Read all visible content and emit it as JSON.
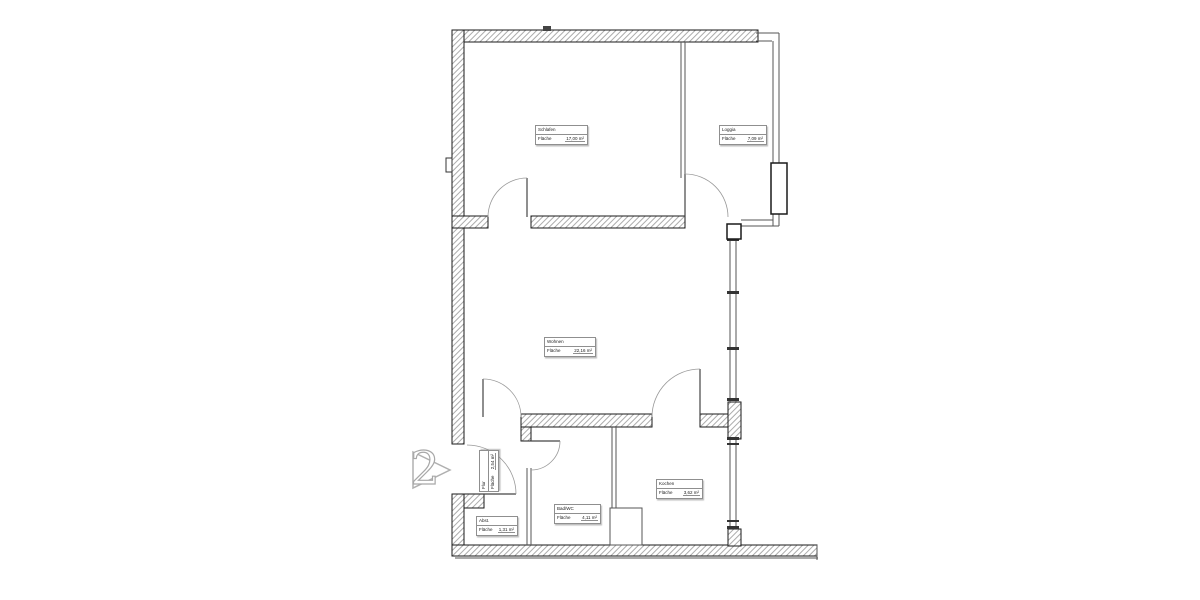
{
  "plan": {
    "title": "floor-plan-unit-2",
    "area_word": "Fläche",
    "marker": {
      "number": "2"
    },
    "rooms": [
      {
        "name": "Schlafen",
        "area": "17,00 m²"
      },
      {
        "name": "Loggia",
        "area": "7,09 m²"
      },
      {
        "name": "Wohnen",
        "area": "22,16 m²"
      },
      {
        "name": "Kochen",
        "area": "3,62 m²"
      },
      {
        "name": "Bad/WC",
        "area": "4,11 m²"
      },
      {
        "name": "Abst.",
        "area": "1,31 m²"
      },
      {
        "name": "Flur",
        "area": "2,54 m²"
      }
    ],
    "colors": {
      "wall_outline": "#1a1a1a",
      "wall_hatch": "#ababab",
      "thin_wall": "#555555",
      "door_arc": "#999999",
      "label_border": "#8f8f8f",
      "marker_outline": "#aaaaaa"
    }
  }
}
